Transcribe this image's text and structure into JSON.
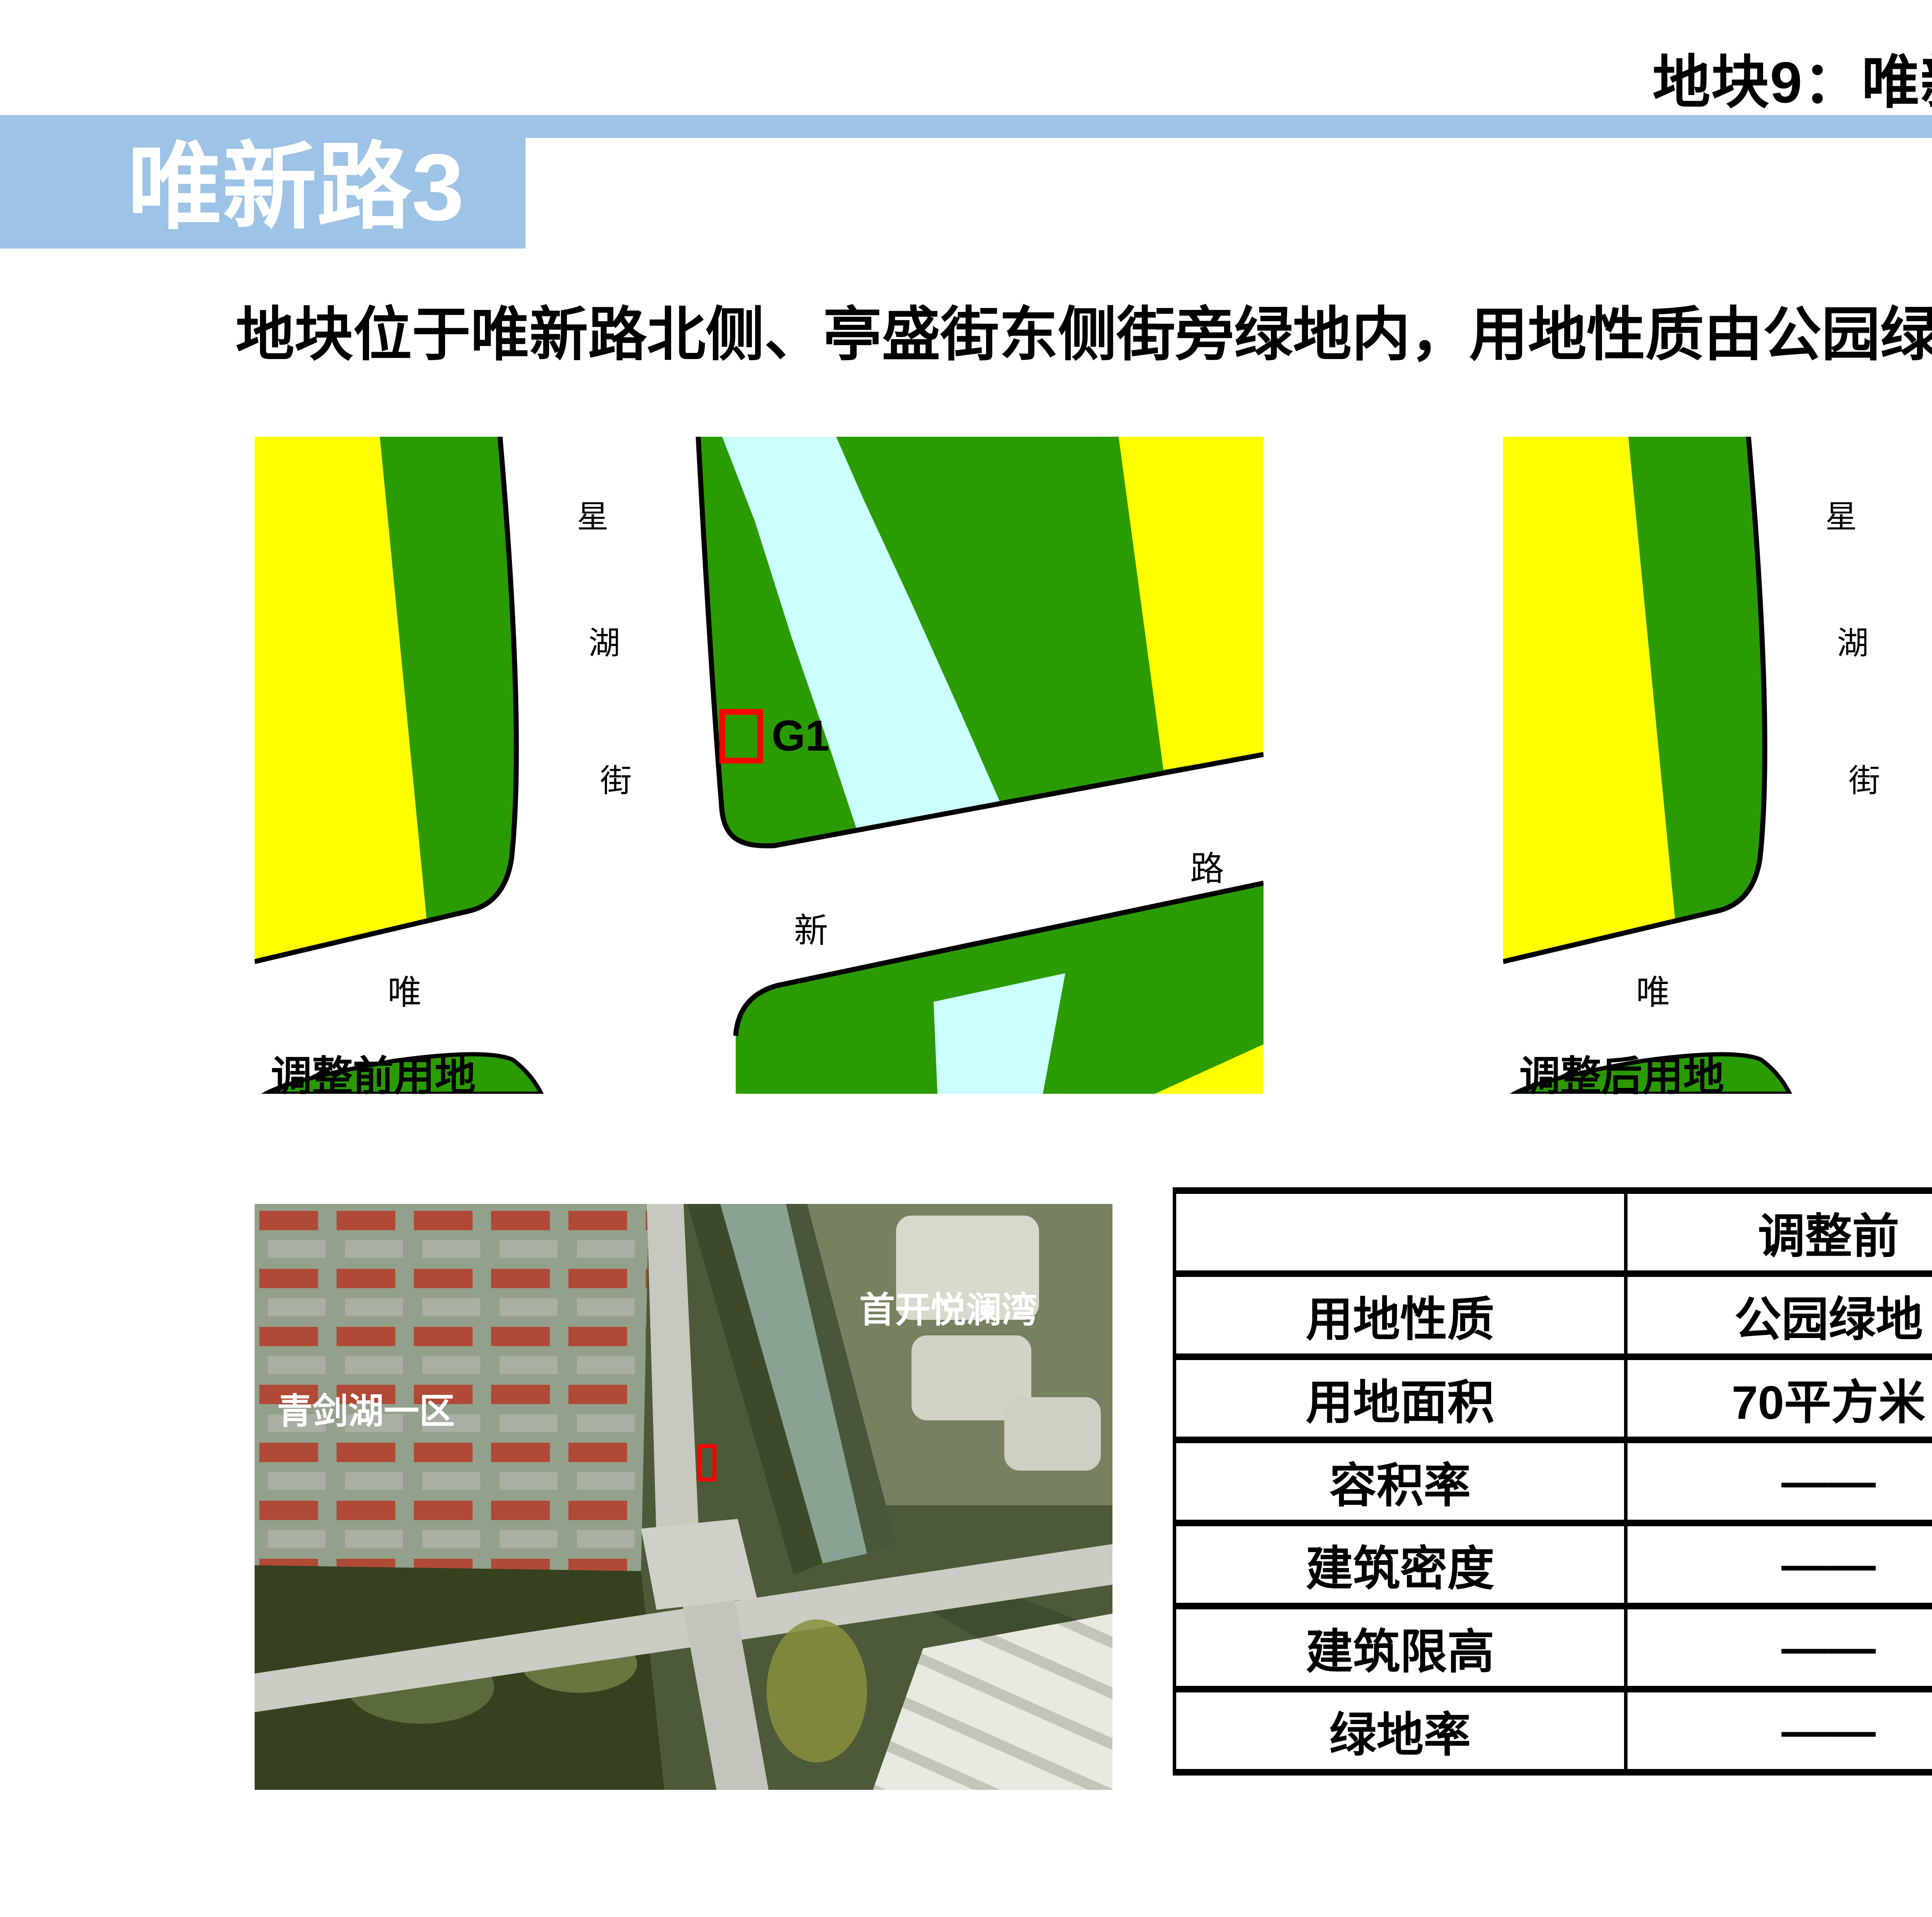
{
  "header": {
    "page_title": "地块9：唯新路、城北路相关开闭所地块",
    "band_label": "唯新路3"
  },
  "description": "地块位于唯新路北侧、亭盛街东侧街旁绿地内，用地性质由公园绿地调整为供电用地。",
  "maps": {
    "before_caption": "调整前用地",
    "after_caption": "调整后用地",
    "marker_before_label": "G1",
    "marker_after_label": "U12",
    "street_chars": {
      "c1": "星",
      "c2": "湖",
      "c3": "街"
    },
    "road_chars": {
      "wei": "唯",
      "xin": "新",
      "lu": "路"
    }
  },
  "satellite": {
    "label_right": "首开悦澜湾",
    "label_left": "青剑湖一区"
  },
  "table": {
    "col_before": "调整前",
    "col_after": "调整后",
    "rows": [
      {
        "label": "用地性质",
        "before": "公园绿地",
        "after": "供电用地"
      },
      {
        "label": "用地面积",
        "before": "70平方米",
        "after": "70平方米"
      },
      {
        "label": "容积率",
        "before": "——",
        "after": "0.5"
      },
      {
        "label": "建筑密度",
        "before": "——",
        "after": "——"
      },
      {
        "label": "建筑限高",
        "before": "——",
        "after": "12米"
      },
      {
        "label": "绿地率",
        "before": "——",
        "after": "——"
      }
    ]
  },
  "page_number": "32",
  "colors": {
    "band_blue": "#9DC3E6",
    "landuse_green": "#2B9B02",
    "landuse_yellow": "#FFFF00",
    "water_cyan": "#CCFFFF",
    "marker_red": "#FF0000",
    "marker_blue": "#2038E8",
    "highlight_red": "#FF0000",
    "page_number_gray": "#8C8C8C"
  }
}
